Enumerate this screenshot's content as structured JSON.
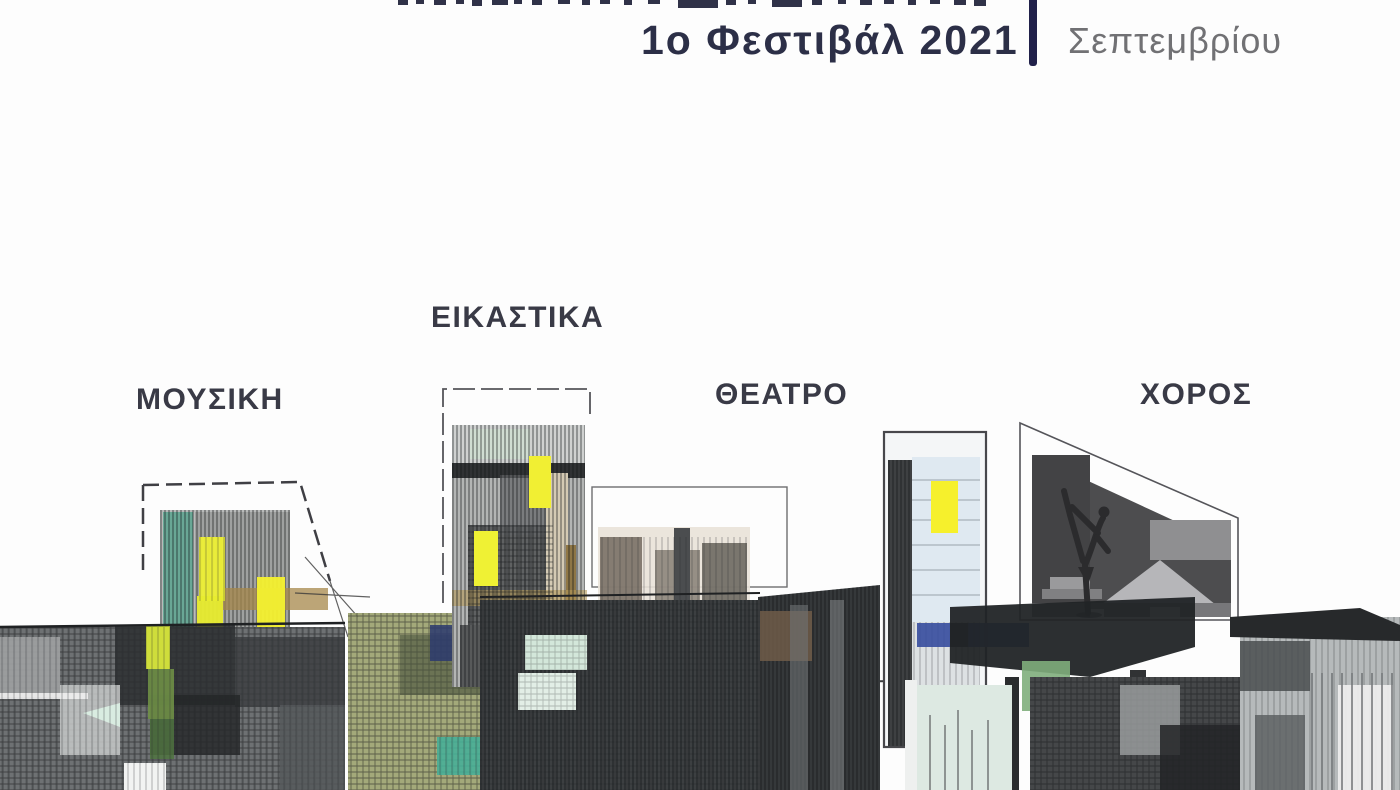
{
  "header": {
    "festival_line": "1ο Φεστιβάλ 2021",
    "month": "Σεπτεμβρίου"
  },
  "categories": [
    {
      "label": "ΜΟΥΣΙΚΗ"
    },
    {
      "label": "ΕΙΚΑΣΤΙΚΑ"
    },
    {
      "label": "ΘΕΑΤΡΟ"
    },
    {
      "label": "ΧΟΡΟΣ"
    }
  ],
  "palette": {
    "accent_navy": "#21214a",
    "title_navy": "#2c2f47",
    "month_gray": "#717174",
    "label_dark": "#393a46",
    "highlight_yellow": "#f2ee35",
    "teal": "#45ae97",
    "mint": "#dce9e2",
    "blue": "#3a4f9f",
    "ochre": "#a8894d",
    "charcoal": "#2a2c2e"
  }
}
